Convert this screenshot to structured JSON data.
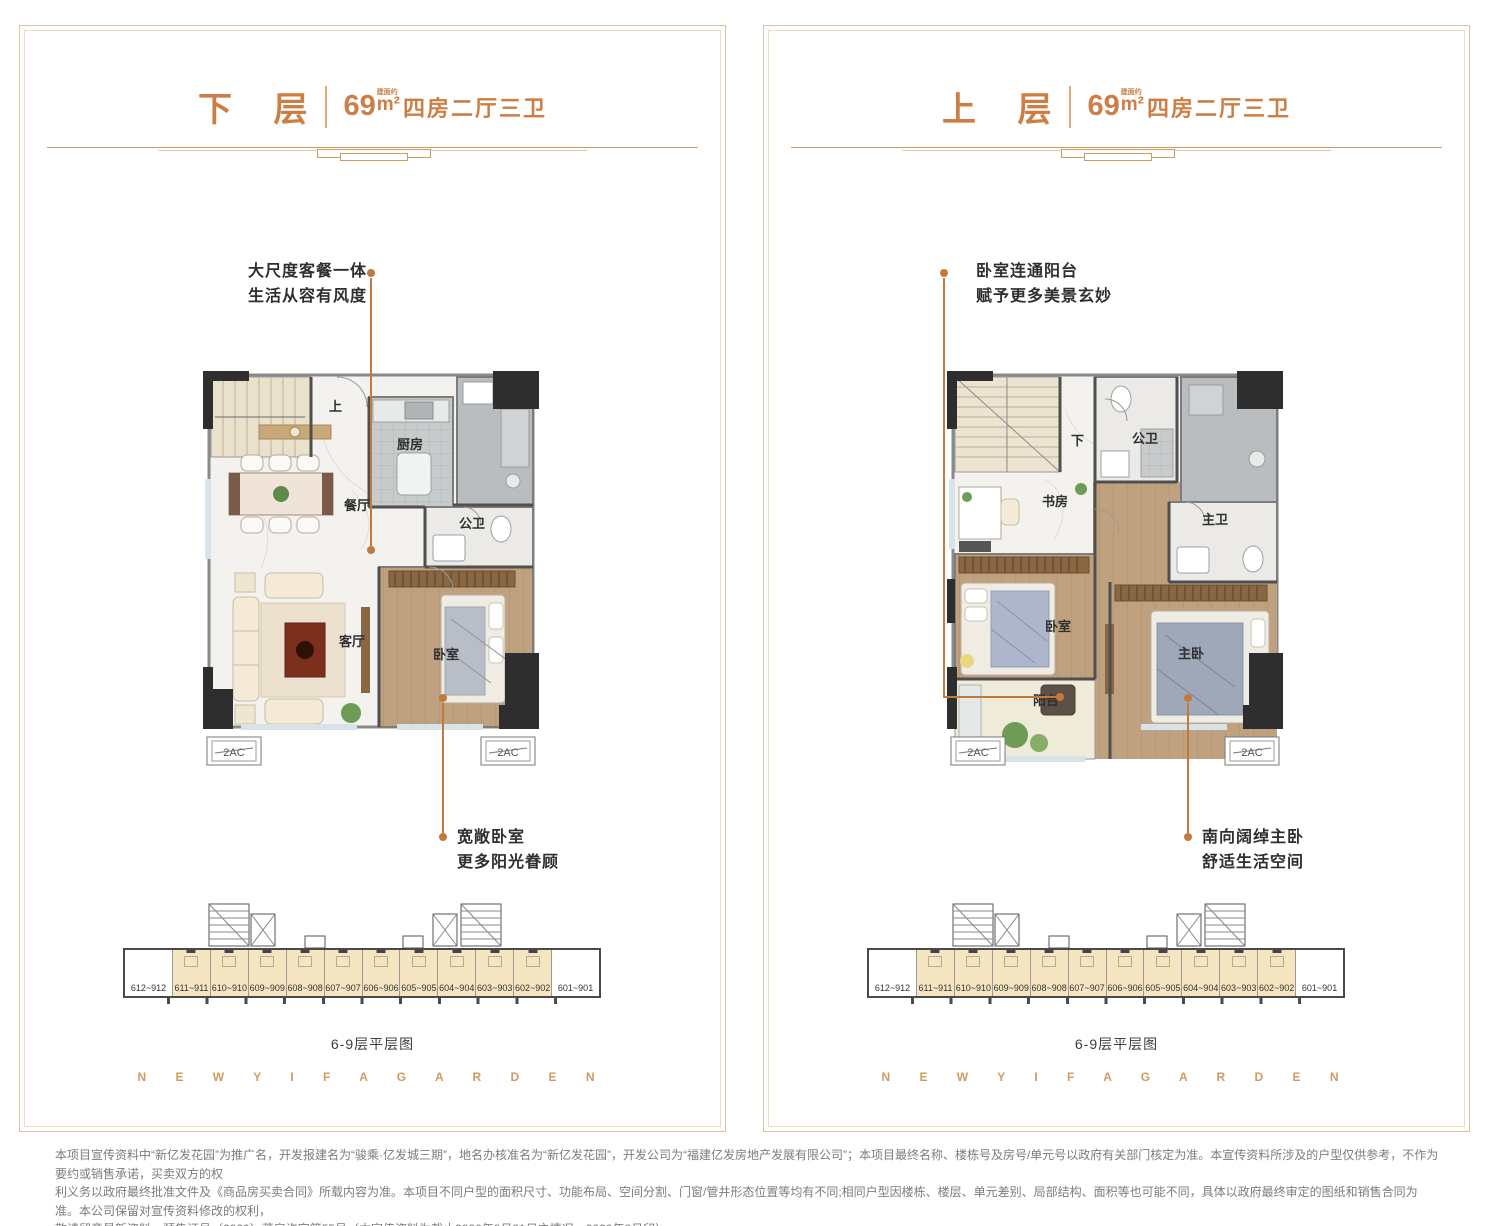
{
  "colors": {
    "accent_orange": "#cd7e44",
    "annotation_line": "#c07a3d",
    "panel_border": "#d9c3a0",
    "strip_highlight": "#f6e5c1",
    "footer_text": "#d09a62"
  },
  "panels": [
    {
      "title": "下 层",
      "area_value": "69",
      "area_note": "建面约",
      "area_unit": "m²",
      "spec": "四房二厅三卫",
      "annotation_top": {
        "line1": "大尺度客餐一体",
        "line2": "生活从容有风度"
      },
      "annotation_bottom": {
        "line1": "宽敞卧室",
        "line2": "更多阳光眷顾"
      },
      "rooms": {
        "stair": "上",
        "kitchen": "厨房",
        "dining": "餐厅",
        "bath": "公卫",
        "living": "客厅",
        "bedroom": "卧室"
      },
      "ac_label": "2AC",
      "strip_caption": "6-9层平层图"
    },
    {
      "title": "上 层",
      "area_value": "69",
      "area_note": "建面约",
      "area_unit": "m²",
      "spec": "四房二厅三卫",
      "annotation_top": {
        "line1": "卧室连通阳台",
        "line2": "赋予更多美景玄妙"
      },
      "annotation_bottom": {
        "line1": "南向阔绰主卧",
        "line2": "舒适生活空间"
      },
      "rooms": {
        "stair": "下",
        "bath": "公卫",
        "study": "书房",
        "master_bath": "主卫",
        "bedroom": "卧室",
        "master_bedroom": "主卧",
        "balcony": "阳台"
      },
      "ac_label": "2AC",
      "strip_caption": "6-9层平层图"
    }
  ],
  "strip_units": [
    "612~912",
    "611~911",
    "610~910",
    "609~909",
    "608~908",
    "607~907",
    "606~906",
    "605~905",
    "604~904",
    "603~903",
    "602~902",
    "601~901"
  ],
  "footer_brand": "N E W   Y I F A   G A R D E N",
  "disclaimer": {
    "line1": "本项目宣传资料中“新亿发花园”为推广名，开发报建名为“骏乘·亿发城三期”，地名办核准名为“新亿发花园”，开发公司为“福建亿发房地产发展有限公司”；本项目最终名称、楼栋号及房号/单元号以政府有关部门核定为准。本宣传资料所涉及的户型仅供参考，不作为要约或销售承诺，买卖双方的权",
    "line2": "利义务以政府最终批准文件及《商品房买卖合同》所载内容为准。本项目不同户型的面积尺寸、功能布局、空间分割、门窗/管井形态位置等均有不同;相同户型因楼栋、楼层、单元差别、局部结构、面积等也可能不同，具体以政府最终审定的图纸和销售合同为准。本公司保留对宣传资料修改的权利，",
    "line3": "敬请留意最新资料。预售证号（2020）莆房许字第55号（本宣传资料为截止2020年8月31日之情况。2020年8月印）"
  }
}
